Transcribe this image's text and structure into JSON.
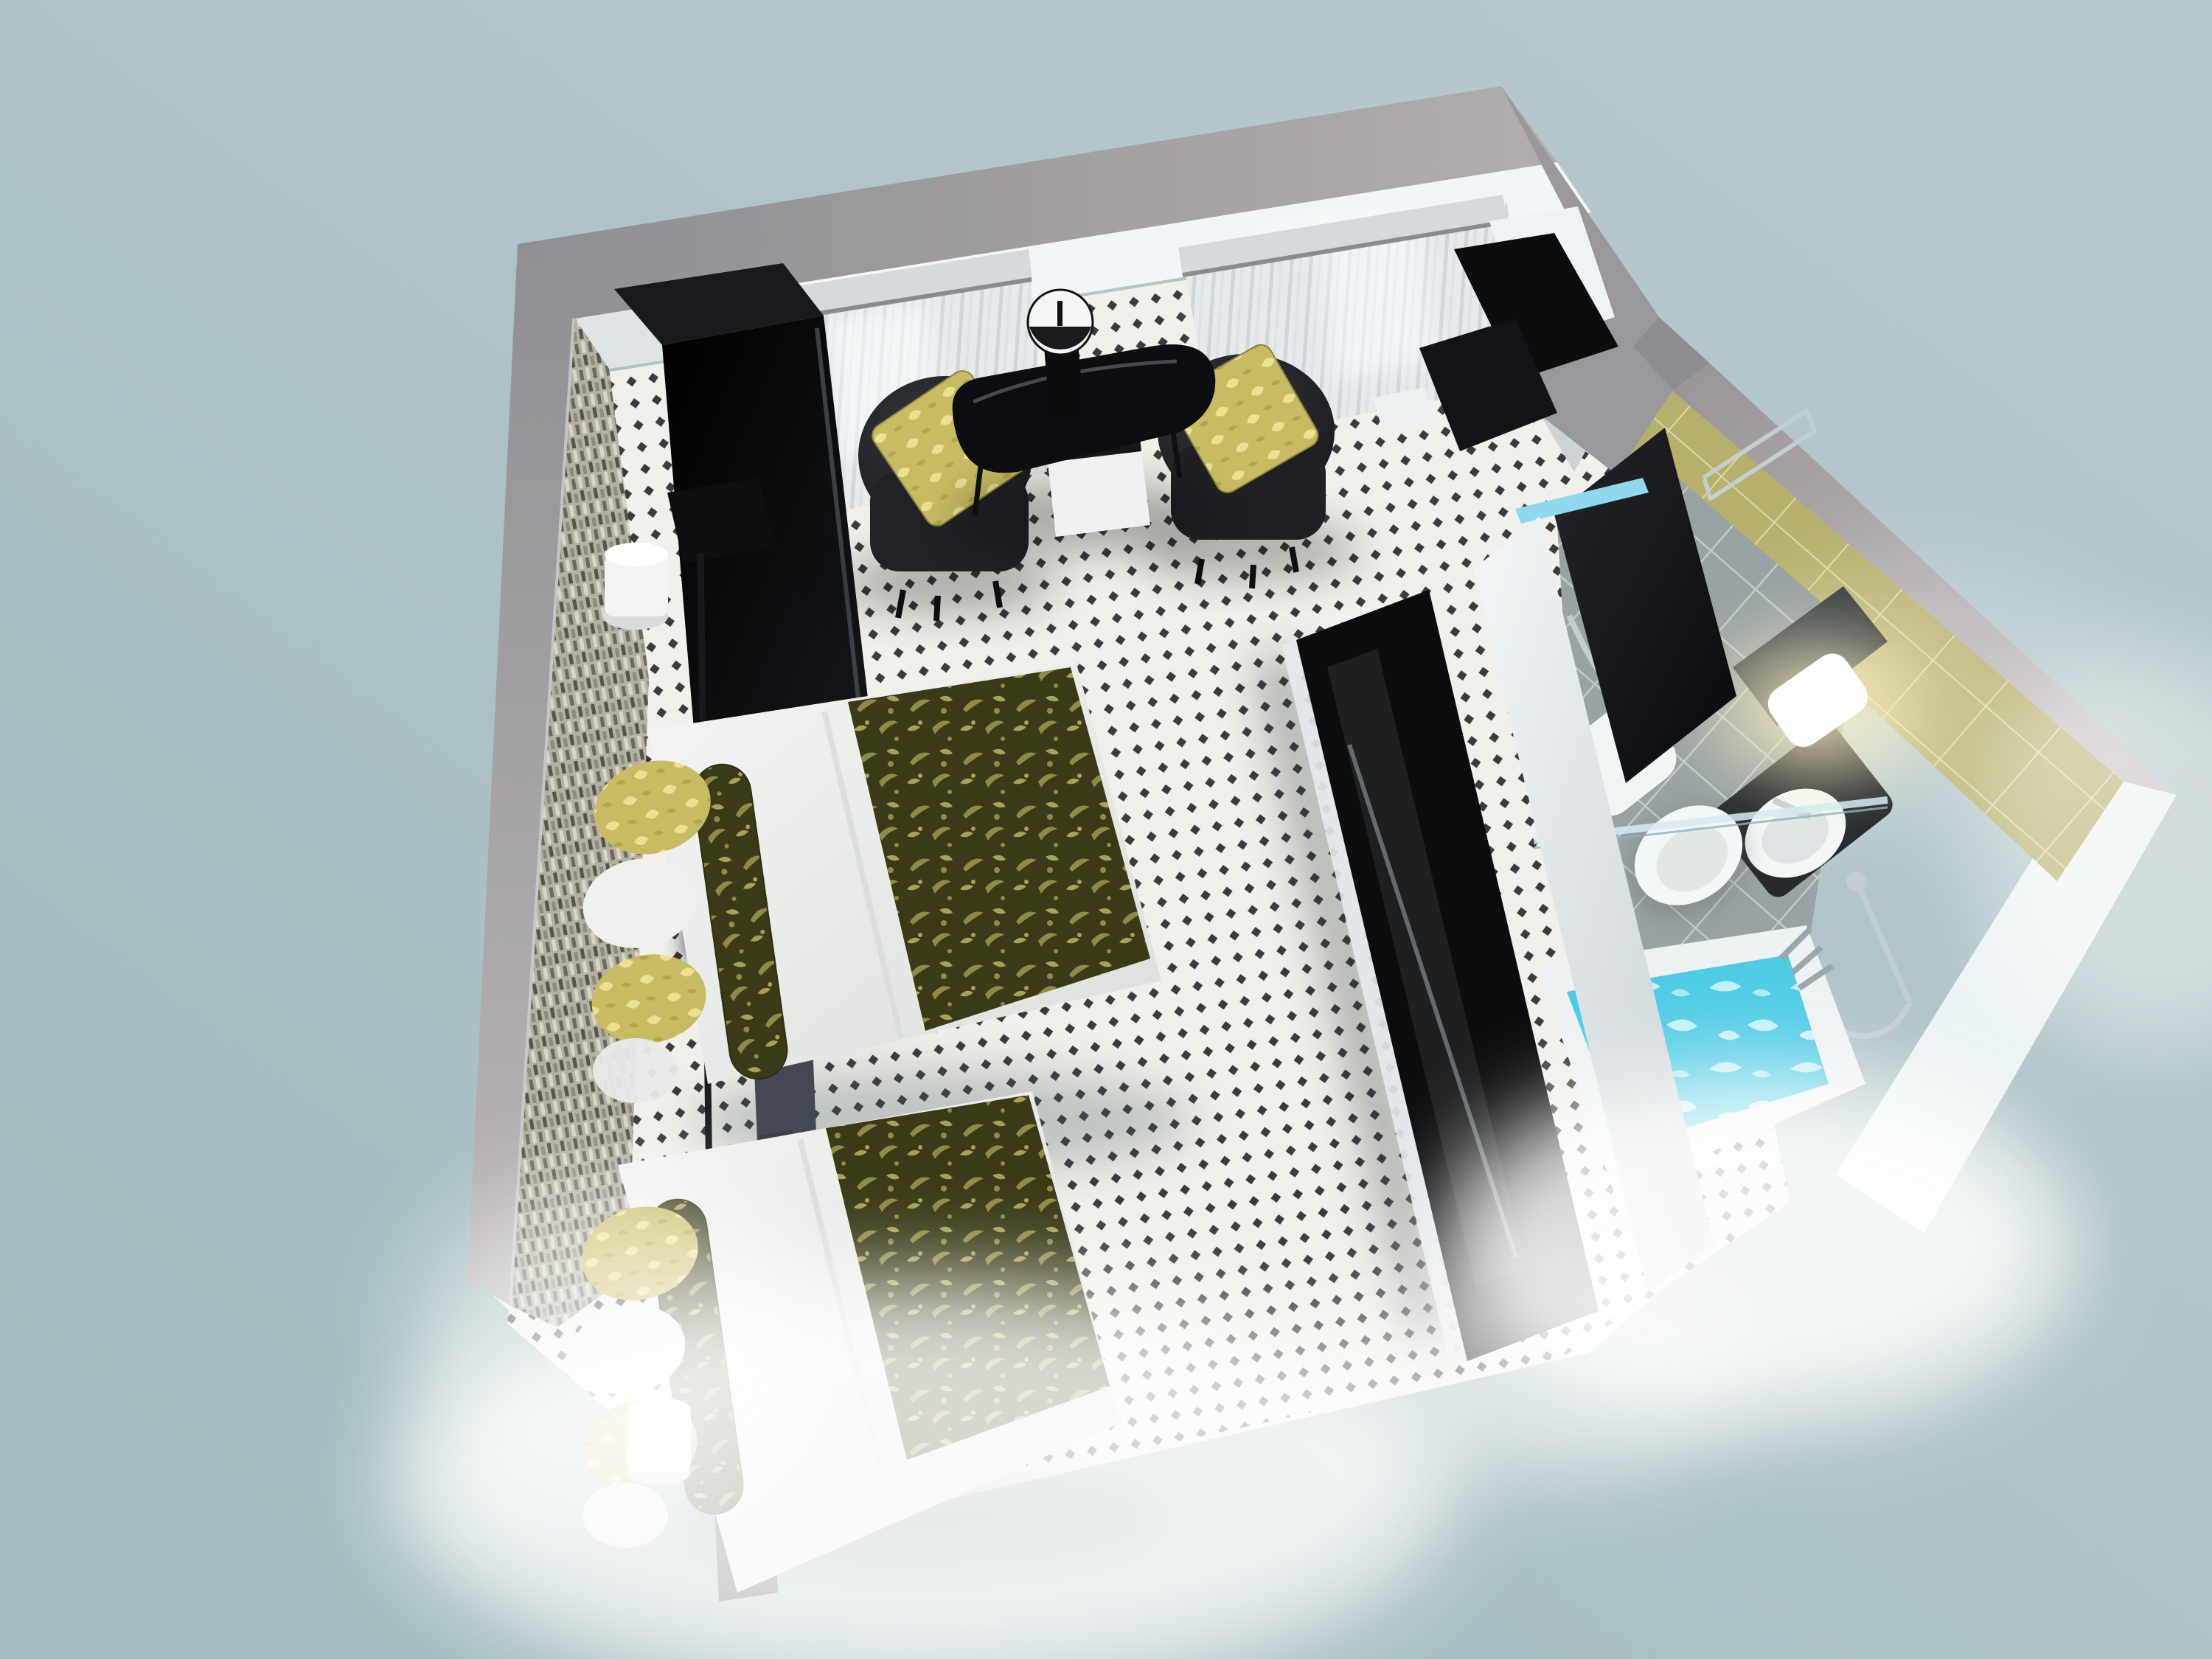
{
  "scene": {
    "title": "3D cutaway floor plan of a twin hotel room with en-suite bathroom, viewed from above",
    "view": "top-down isometric dollhouse render on plain blue-grey backdrop",
    "rooms": [
      {
        "name": "bedroom",
        "floor": "white carpet with black diamond lattice pattern",
        "items": [
          "glossy black wardrobe",
          "black floor lamp",
          "twin bed 1 with white duvet and olive floral runner",
          "twin bed 2 with white duvet and olive floral runner",
          "gold damask and white scatter pillows",
          "slate headboard panels",
          "white cylinder reading lamps",
          "mosaic tiled headboard wall",
          "two windows with sheer curtains and pelmets",
          "black tub armchair with gold cushion (left)",
          "black tub armchair with gold cushion (right)",
          "black glass cocktail table",
          "table lamp with white drum shade",
          "white minibar cabinet",
          "black media console with TV"
        ]
      },
      {
        "name": "entry",
        "items": [
          "black writing desk",
          "black desk chair"
        ]
      },
      {
        "name": "bathroom",
        "floor": "grey ceramic tiles",
        "walls": "olive green tiles",
        "items": [
          "dark entry door with cyan light strip",
          "white toilet",
          "dark vanity with round white basin",
          "wall mirror",
          "glowing white wall light",
          "chrome towel rail",
          "chrome grab bar",
          "glass shelf screen",
          "chrome shower set",
          "bathtub filled with aqua water"
        ]
      }
    ]
  },
  "palette": {
    "background_top": "#b9cacd",
    "background_bottom": "#a4bbbf",
    "outer_wall": "#8f8e92",
    "outer_wall_light": "#b3adaf",
    "inner_wall": "#f3f6f8",
    "mosaic_base": "#b4b1a2",
    "mosaic_dark": "#56554b",
    "mosaic_light": "#d9d6c8",
    "floor_base": "#f1f0ea",
    "floor_diamond": "#393b3e",
    "curtain": "#e7ebee",
    "pelmet": "#d5dadd",
    "furniture_black": "#0b0c0e",
    "chair_body": "#26282d",
    "gold": "#c8bc63",
    "gold_light": "#ebe191",
    "runner_dark": "#3a3a18",
    "runner_leaf": "#8f8a45",
    "duvet": "#f5f6f4",
    "headboard": "#454652",
    "partition": "#eef2f4",
    "olive_tile": "#b5b06b",
    "olive_grout": "#e4e1af",
    "gray_tile": "#99a2a4",
    "gray_grout": "#c7cecf",
    "door": "#16171c",
    "cyan_strip": "#8fd9ef",
    "ceramic": "#f4f7f7",
    "vanity": "#262a2f",
    "chrome": "#c3ced2",
    "water": "#4ecbe5",
    "water_light": "#cdf4fb",
    "lamp_glow": "#fff3c4"
  }
}
